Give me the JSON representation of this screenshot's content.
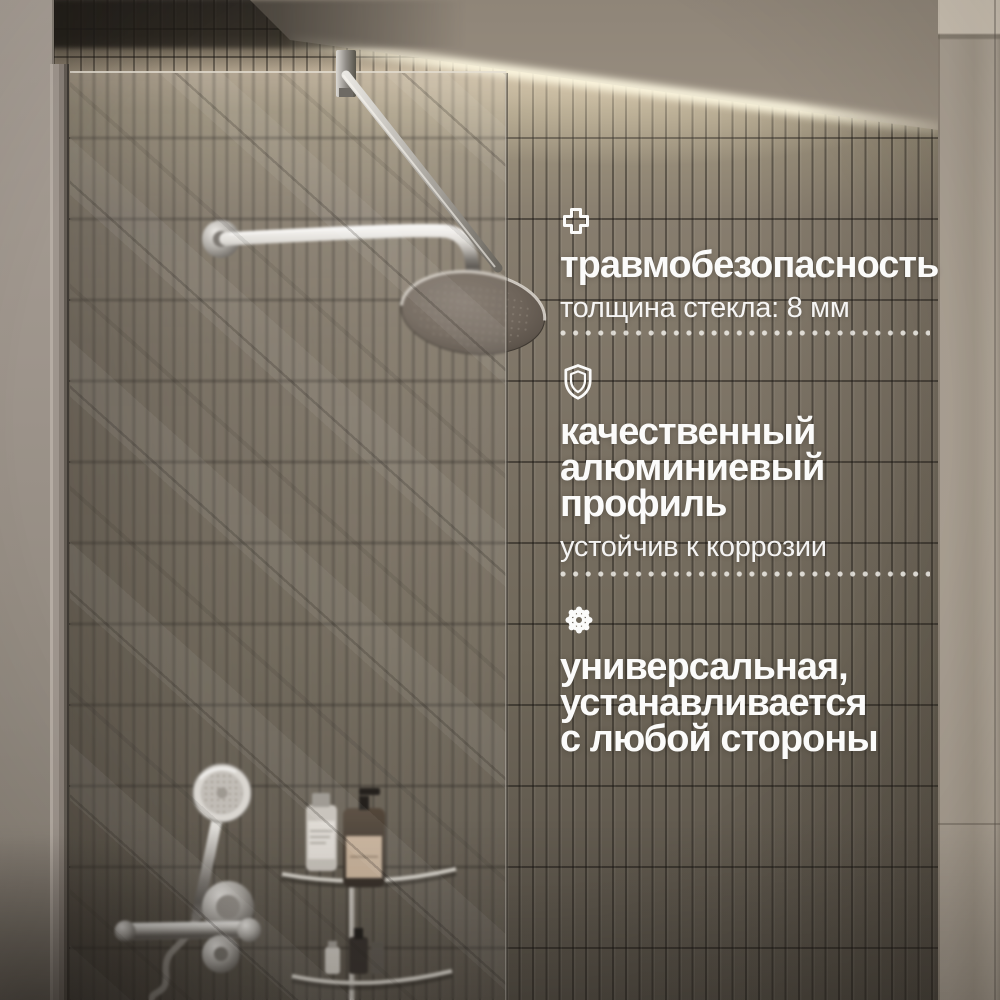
{
  "type": "product-feature-banner",
  "language_note": "ru",
  "features": [
    {
      "icon": "plus-icon",
      "title": "травмобезопасность",
      "subtitle": "толщина стекла: 8 мм"
    },
    {
      "icon": "shield-icon",
      "title": "качественный\nалюминиевый\nпрофиль",
      "subtitle": "устойчив к коррозии"
    },
    {
      "icon": "gear-icon",
      "title": "универсальная,\nустанавливается\nс любой стороны",
      "subtitle": ""
    }
  ],
  "colors": {
    "text": "#fafaf8",
    "divider_dots": "#f0ede6",
    "tile_wall": "#6e6659",
    "tile_wall_dark": "#554e45",
    "cove_glow": "#f2e3c4",
    "side_wall": "#a59b8d",
    "chrome": "#d7d4cf"
  }
}
